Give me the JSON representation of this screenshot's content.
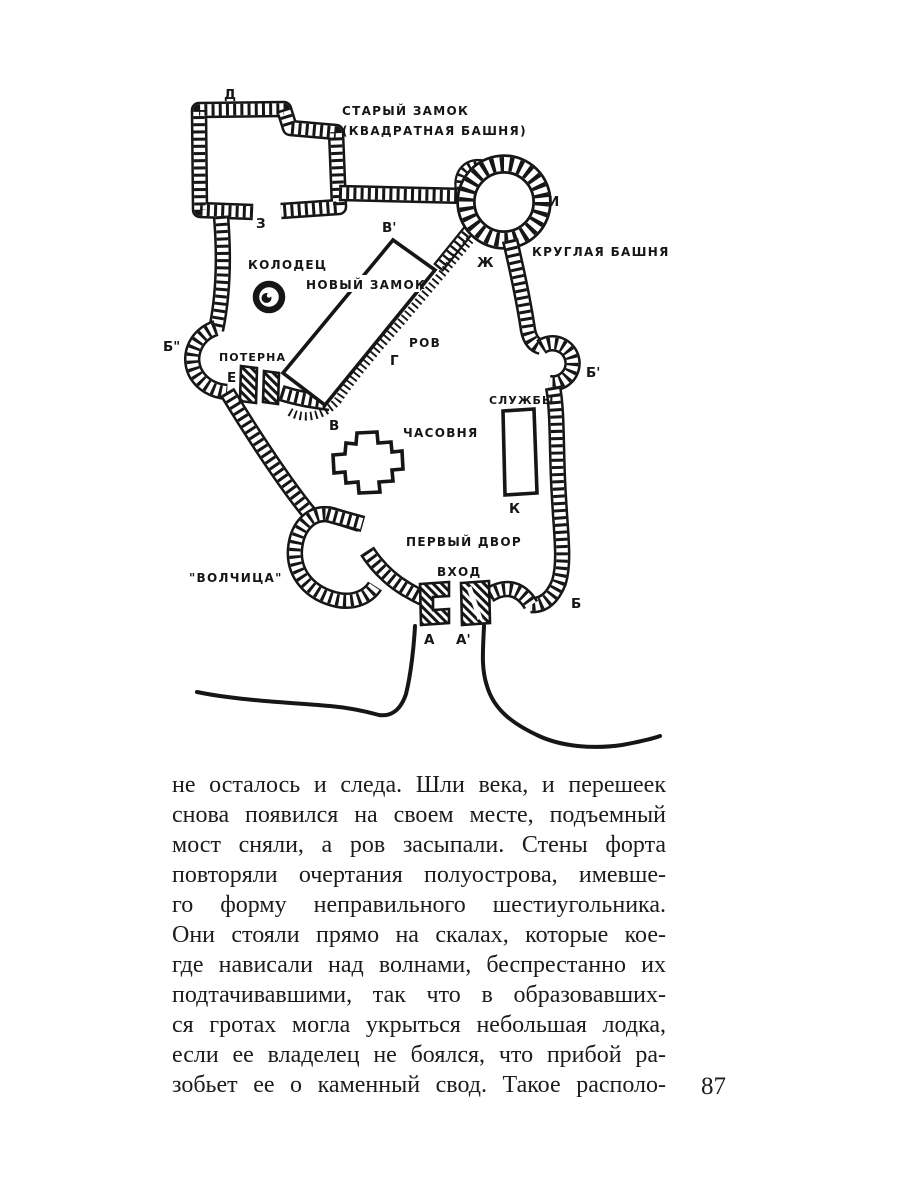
{
  "page": {
    "number": "87"
  },
  "figure": {
    "labels": {
      "old_castle_line1": "СТАРЫЙ ЗАМОК",
      "old_castle_line2": "(КВАДРАТНАЯ БАШНЯ)",
      "round_tower": "КРУГЛАЯ БАШНЯ",
      "well": "КОЛОДЕЦ",
      "new_castle": "НОВЫЙ ЗАМОК",
      "postern": "ПОТЕРНА",
      "moat": "РОВ",
      "chapel": "ЧАСОВНЯ",
      "services": "СЛУЖБЫ",
      "first_courtyard": "ПЕРВЫЙ ДВОР",
      "entrance": "ВХОД",
      "wolf_bastion": "\"ВОЛЧИЦА\""
    },
    "points": {
      "d": "Д",
      "z": "З",
      "i": "И",
      "zh": "Ж",
      "b_double_prime": "Б\"",
      "b_prime": "Б'",
      "e": "Е",
      "g": "Г",
      "v": "В",
      "v_prime": "В'",
      "k": "К",
      "b": "Б",
      "a": "А",
      "a_prime": "А'"
    }
  },
  "body": {
    "lines": [
      "не осталось и следа. Шли века, и перешеек",
      "снова появился на своем месте, подъемный",
      "мост сняли, а ров засыпали. Стены форта",
      "повторяли очертания полуострова, имевше-",
      "го форму неправильного шестиугольника.",
      "Они стояли прямо на скалах, которые кое-",
      "где нависали над волнами, беспрестанно их",
      "подтачивавшими, так что в образовавших-",
      "ся гротах могла укрыться небольшая лодка,",
      "если ее владелец не боялся, что прибой ра-",
      "зобьет ее о каменный свод. Такое располо-"
    ]
  }
}
